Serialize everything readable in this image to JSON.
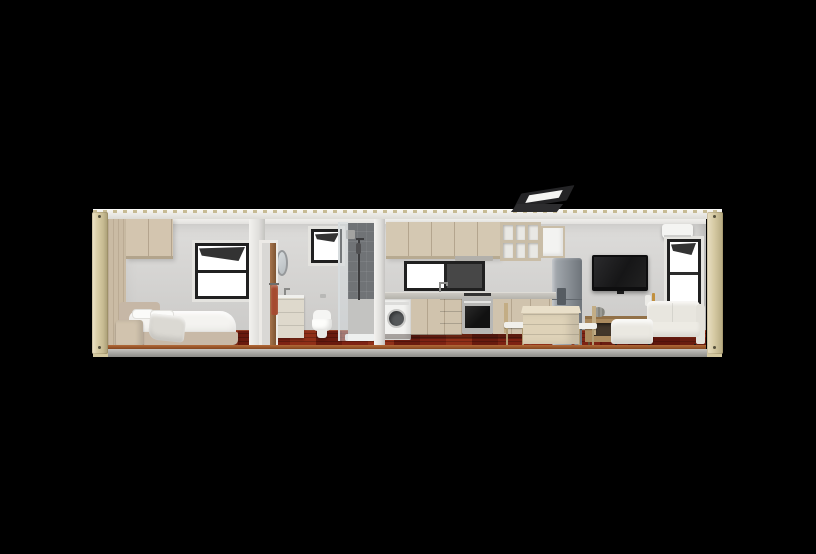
{
  "scene": {
    "type": "3d-cutaway-render",
    "subject": "Shipping container tiny home, longitudinal section elevation on black background",
    "background_color": "#000000",
    "palette": {
      "container_shell": "#d9cda6",
      "roof_fascia": "#ebe9e4",
      "interior_wall": "#d5d4d2",
      "ceiling": "#f2f1ee",
      "wood_floor": "#7e2213",
      "floor_cut_edge": "#a0592c",
      "cabinet_wood": "#d2c5af",
      "base_rail": "#a3a29e",
      "window_frame": "#202020",
      "shower_tile": "#707376",
      "sofa_fabric": "#e8e6df",
      "appliance_steel": "#8f959a",
      "bed_frame": "#c6b7a6",
      "towel": "#a54b30",
      "console_wood": "#ab8a5e"
    },
    "rooms": [
      {
        "label": "Bedroom",
        "items": [
          "wardrobe column",
          "overhead cabinet",
          "awning window (top sash open)",
          "double bed with white duvet and pillows",
          "upholstered headboard",
          "grey throw blanket",
          "timber nightstand"
        ]
      },
      {
        "label": "Bathroom",
        "items": [
          "timber sliding door",
          "towel rail with rust towel",
          "round mirror",
          "vanity unit with faucet",
          "small awning window",
          "toilet",
          "walk-in shower with dark tiles, glass screen and rail shower"
        ]
      },
      {
        "label": "Kitchen / Laundry",
        "items": [
          "upper cabinets",
          "range hood",
          "open cube shelving",
          "white wall cabinet",
          "wide sliding window",
          "gooseneck sink faucet",
          "front-load washing machine",
          "base cabinets with drawers",
          "stainless oven with cooktop",
          "opened roof skylight"
        ]
      },
      {
        "label": "Living / Dining",
        "items": [
          "cube dining table with drawers",
          "two timber dining chairs with white cushions",
          "double-door refrigerator with dispenser",
          "wall-mounted flat-screen TV",
          "timber media console with bowl and bottles",
          "cream corner sofa with chaise",
          "split air-conditioning unit",
          "end awning window",
          "dark red rug"
        ]
      }
    ],
    "shell": {
      "left_corner_post": "corrugated beige steel",
      "right_corner_post": "corrugated beige steel",
      "roof": "white fascia with corrugation ticks",
      "base": "grey bottom rail with beige corner castings"
    },
    "window_count": 5,
    "skylight_count": 1
  }
}
